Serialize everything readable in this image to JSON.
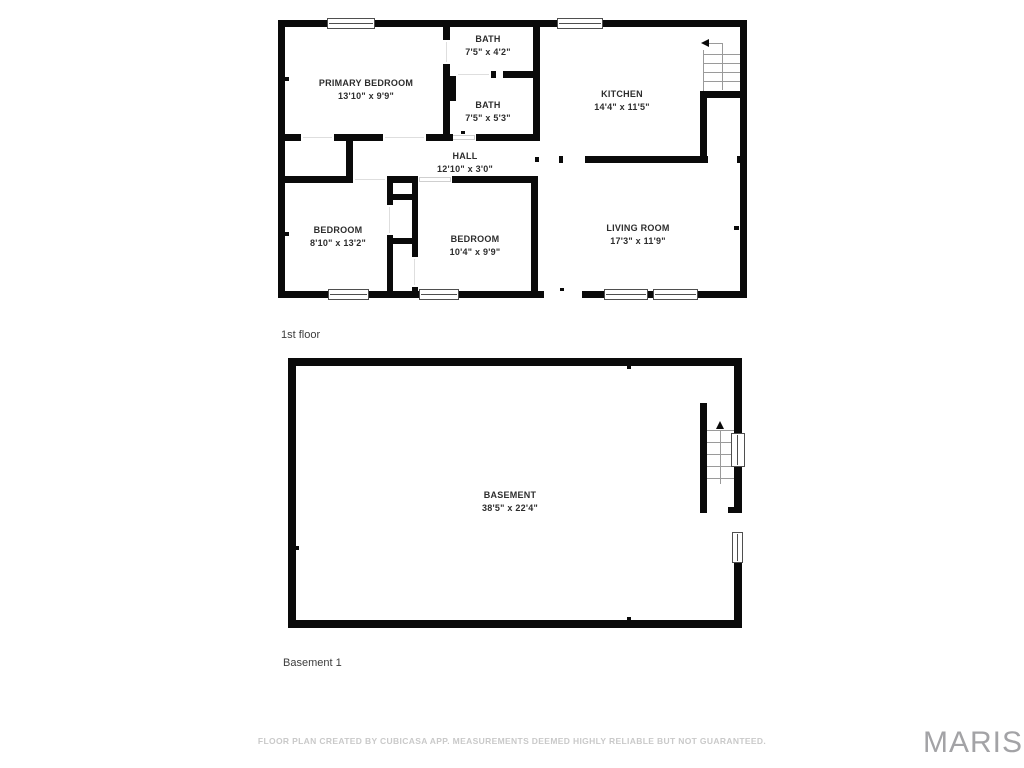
{
  "page": {
    "background": "#ffffff"
  },
  "floors": [
    {
      "id": "floor-1",
      "label": "1st floor",
      "rooms": [
        {
          "name": "PRIMARY BEDROOM",
          "dims": "13'10\" x 9'9\""
        },
        {
          "name": "BATH",
          "dims": "7'5\" x 4'2\""
        },
        {
          "name": "BATH",
          "dims": "7'5\" x 5'3\""
        },
        {
          "name": "KITCHEN",
          "dims": "14'4\" x 11'5\""
        },
        {
          "name": "HALL",
          "dims": "12'10\" x 3'0\""
        },
        {
          "name": "BEDROOM",
          "dims": "8'10\" x 13'2\""
        },
        {
          "name": "BEDROOM",
          "dims": "10'4\" x 9'9\""
        },
        {
          "name": "LIVING ROOM",
          "dims": "17'3\" x 11'9\""
        }
      ]
    },
    {
      "id": "basement-1",
      "label": "Basement 1",
      "rooms": [
        {
          "name": "BASEMENT",
          "dims": "38'5\" x 22'4\""
        }
      ]
    }
  ],
  "footer": {
    "disclaimer": "FLOOR PLAN CREATED BY CUBICASA APP. MEASUREMENTS DEEMED HIGHLY RELIABLE BUT NOT GUARANTEED.",
    "watermark": "MARIS"
  },
  "colors": {
    "wall": "#0a0a0a",
    "room_label": "#2d2d2d",
    "floor_label": "#3c3c3c",
    "disclaimer": "#c9c9c9",
    "watermark": "#a3a3a6"
  }
}
